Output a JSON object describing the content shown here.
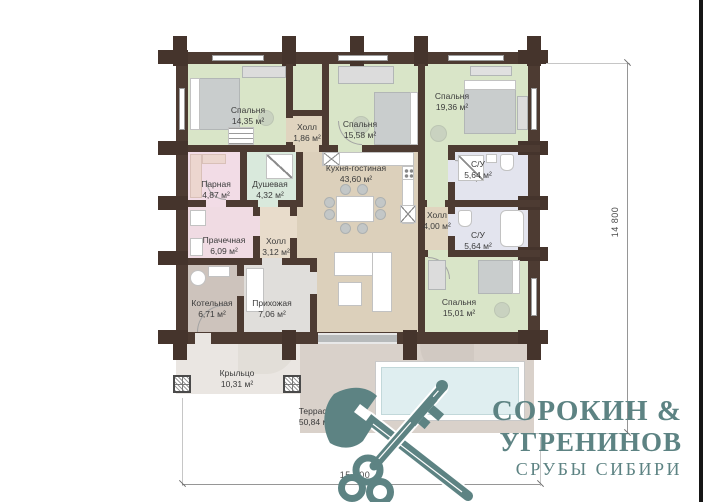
{
  "plan": {
    "rooms": [
      {
        "name": "Спальня",
        "area": "14,35 м²"
      },
      {
        "name": "Холл",
        "area": "1,86 м²"
      },
      {
        "name": "Спальня",
        "area": "15,58 м²"
      },
      {
        "name": "Спальня",
        "area": "19,36 м²"
      },
      {
        "name": "Парная",
        "area": "4,87 м²"
      },
      {
        "name": "Душевая",
        "area": "4,32 м²"
      },
      {
        "name": "Кухня-гостиная",
        "area": "43,60 м²"
      },
      {
        "name": "С/У",
        "area": "5,64 м²"
      },
      {
        "name": "Холл",
        "area": "4,00 м²"
      },
      {
        "name": "С/У",
        "area": "5,64 м²"
      },
      {
        "name": "Прачечная",
        "area": "6,09 м²"
      },
      {
        "name": "Холл",
        "area": "3,12 м²"
      },
      {
        "name": "Котельная",
        "area": "6,71 м²"
      },
      {
        "name": "Прихожая",
        "area": "7,06 м²"
      },
      {
        "name": "Спальня",
        "area": "15,01 м²"
      },
      {
        "name": "Крыльцо",
        "area": "10,31 м²"
      },
      {
        "name": "Терраса",
        "area": "50,84 м²"
      }
    ],
    "dimensions": {
      "height": "14 800",
      "width": "15 200"
    }
  },
  "logo": {
    "line1": "СОРОКИН &",
    "line2": "УГРЕНИНОВ",
    "tagline": "СРУБЫ СИБИРИ",
    "icon": "crossed-axe-and-key-icon",
    "color": "#5d8383"
  },
  "palette": {
    "wall": "#4d3b32",
    "bedroom": "#d9e5c8",
    "kitchen": "#dcd0bb",
    "bathroom": "#e3e4ee",
    "sauna": "#f2dce6",
    "shower": "#d9e9dc",
    "laundry": "#f0dbe3",
    "boiler": "#cdc3bc",
    "entry": "#e0dedb",
    "hall": "#e0d4bf",
    "porch": "#eae6e2",
    "terrace": "#d9d1ca",
    "pool": "#dfeef0"
  }
}
